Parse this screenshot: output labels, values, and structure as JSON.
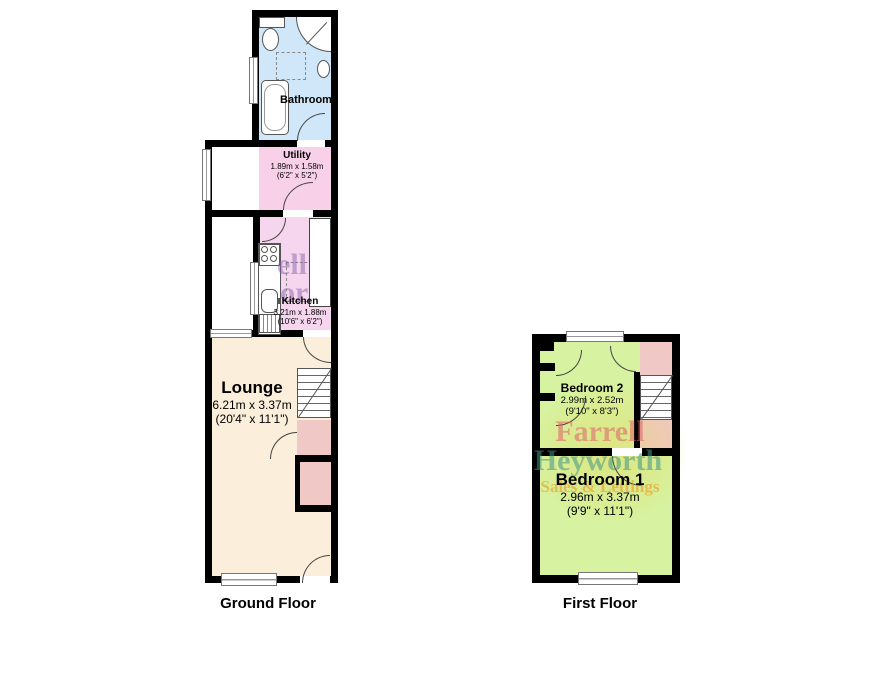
{
  "page": {
    "background": "#ffffff",
    "wall_color": "#000000"
  },
  "ground_floor": {
    "title": "Ground Floor",
    "rooms": {
      "bathroom": {
        "name": "Bathroom",
        "color": "#cfe7f8"
      },
      "utility": {
        "name": "Utility",
        "dims_metric": "1.89m x 1.58m",
        "dims_imperial": "(6'2\" x 5'2\")",
        "color": "#f8d0e8"
      },
      "kitchen": {
        "name": "Kitchen",
        "dims_metric": "3.21m x 1.88m",
        "dims_imperial": "(10'6\" x 6'2\")",
        "color": "#f5d6ee"
      },
      "lounge": {
        "name": "Lounge",
        "dims_metric": "6.21m x 3.37m",
        "dims_imperial": "(20'4\" x 11'1\")",
        "color": "#fbeeda"
      }
    },
    "watermark_fragments": {
      "line1": "ell",
      "line2": "or"
    }
  },
  "first_floor": {
    "title": "First Floor",
    "rooms": {
      "bedroom2": {
        "name": "Bedroom 2",
        "dims_metric": "2.99m x 2.52m",
        "dims_imperial": "(9'10\" x 8'3\")",
        "color": "#d7f2a0"
      },
      "bedroom1": {
        "name": "Bedroom 1",
        "dims_metric": "2.96m x 3.37m",
        "dims_imperial": "(9'9\" x 11'1\")",
        "color": "#d7f2a0"
      }
    },
    "landing_color": "#f0c8c6",
    "watermark": {
      "line1": "Farrell",
      "line2": "Heyworth",
      "line3": "Sales & Lettings"
    }
  }
}
